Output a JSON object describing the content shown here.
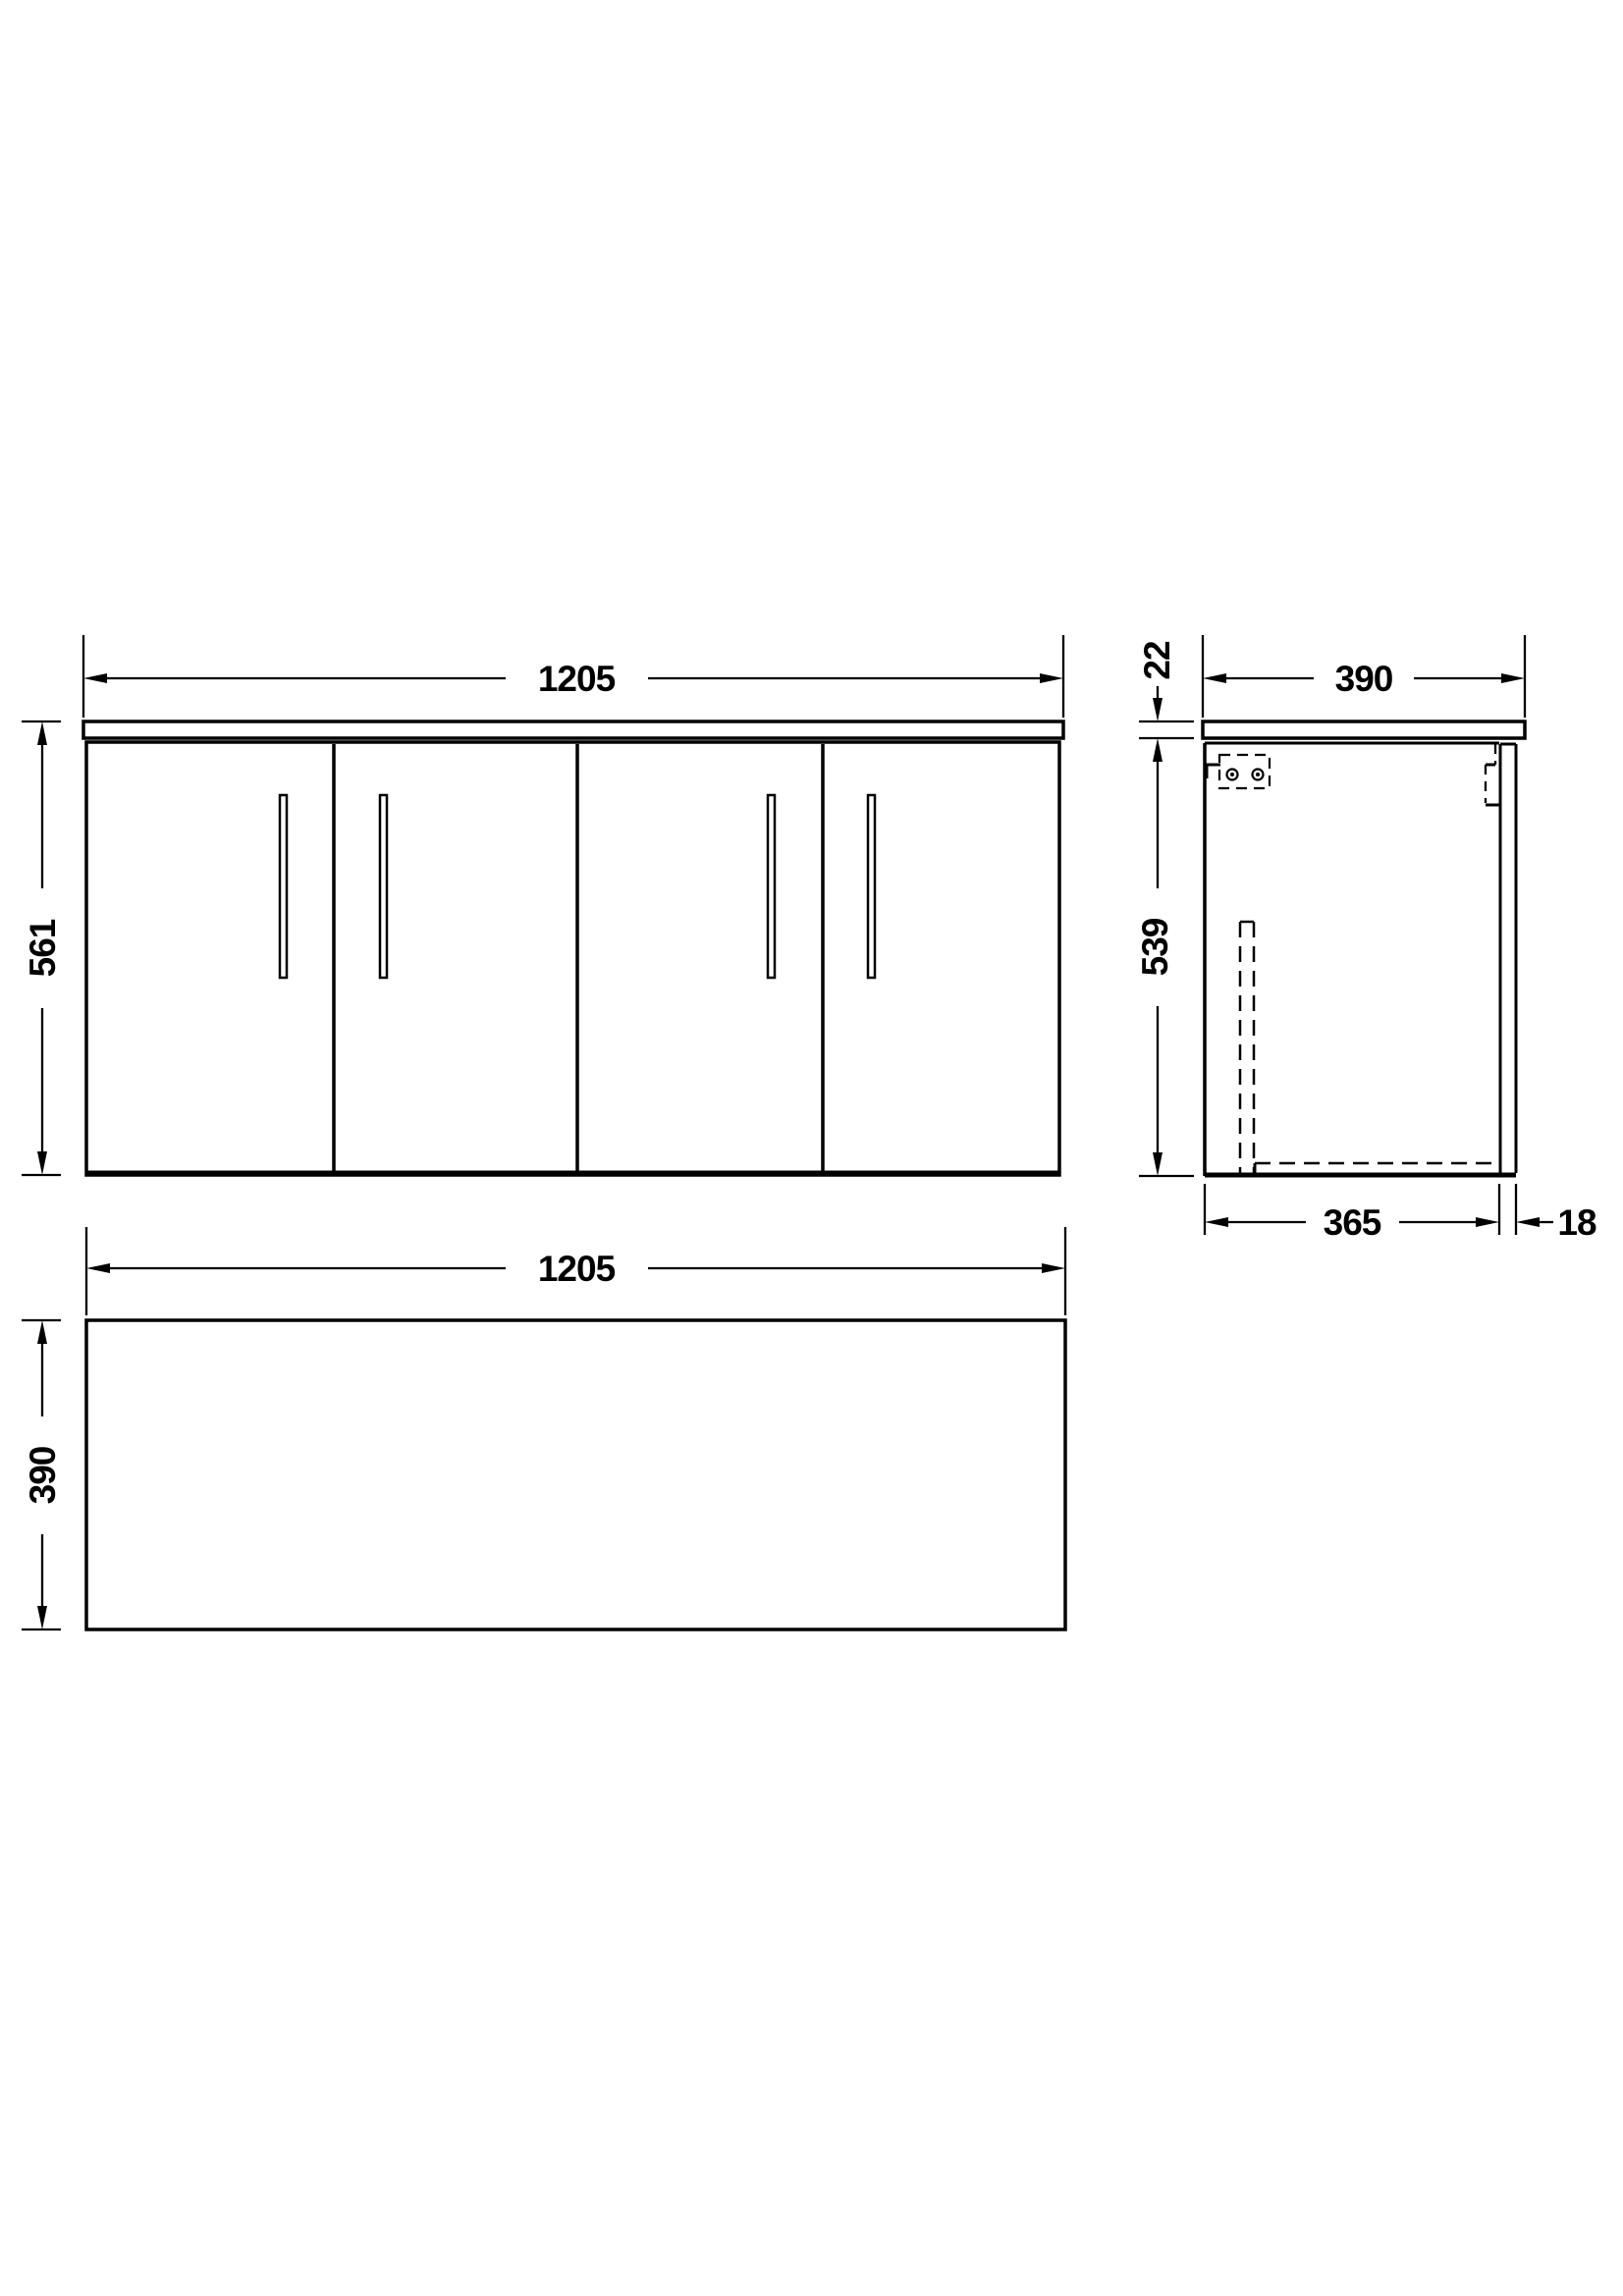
{
  "drawing": {
    "background_color": "#ffffff",
    "line_color": "#000000",
    "front_view": {
      "width_label": "1205",
      "height_label": "561"
    },
    "side_view": {
      "worktop_thickness_label": "22",
      "depth_label": "390",
      "cabinet_height_label": "539",
      "carcass_depth_label": "365",
      "door_thickness_label": "18"
    },
    "plan_view": {
      "width_label": "1205",
      "depth_label": "390"
    }
  }
}
